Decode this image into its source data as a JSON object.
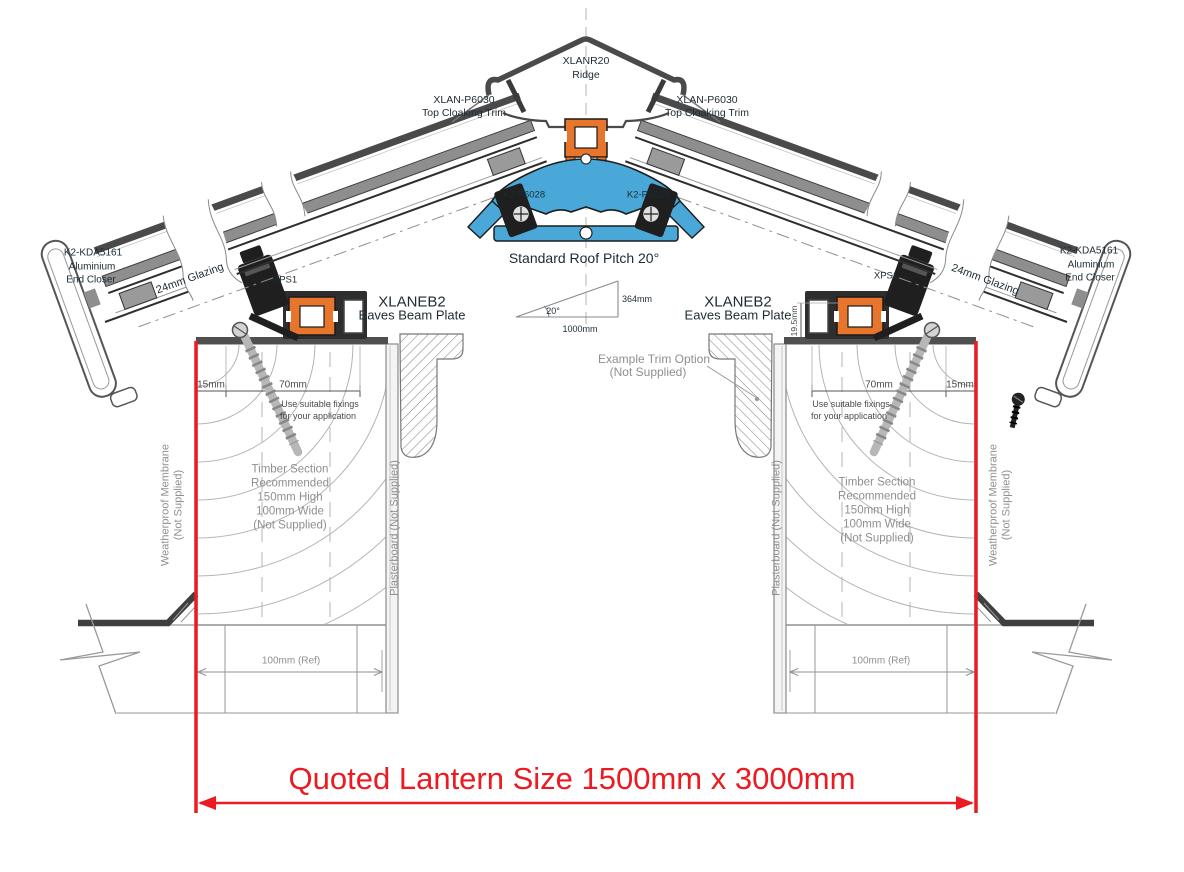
{
  "title": "Roof lantern eaves and ridge cross-section detail",
  "colors": {
    "accent_red": "#ec1a21",
    "aluminium_blue": "#49a8d8",
    "thermal_break_orange": "#e8752c"
  },
  "ridge": {
    "code": "XLANR20",
    "name": "Ridge"
  },
  "top_cloaking_trim": {
    "code": "XLAN-P6030",
    "name": "Top Cloaking Trim"
  },
  "ridge_fixing": {
    "code": "K2-P6028"
  },
  "pitch": {
    "caption": "Standard Roof Pitch 20°",
    "angle": "20°",
    "base": "1000mm",
    "rise": "364mm"
  },
  "end_closer": {
    "code": "K2-KDA5161",
    "material": "Aluminium",
    "name": "End Closer"
  },
  "glazing": {
    "label": "24mm Glazing"
  },
  "gasket": {
    "code": "XPS1"
  },
  "eaves_beam": {
    "code": "XLANEB2",
    "name": "Eaves Beam Plate"
  },
  "trim_option": {
    "line1": "Example  Trim Option",
    "line2": "(Not Supplied)"
  },
  "fixing_note": {
    "line1": "Use suitable fixings",
    "line2": "for your application"
  },
  "timber_note": {
    "lines": [
      "Timber Section",
      "Recommended",
      "150mm High",
      "100mm Wide",
      "(Not Supplied)"
    ]
  },
  "membrane": {
    "line1": "Weatherproof Membrane",
    "line2": "(Not Supplied)"
  },
  "plasterboard": {
    "label": "Plasterboard (Not Supplied)"
  },
  "dimensions": {
    "edge": "15mm",
    "fixing_zone": "70mm",
    "beam_height": "19.5mm",
    "kerb_ref": "100mm (Ref)"
  },
  "quoted_size": {
    "label": "Quoted Lantern Size 1500mm x 3000mm"
  }
}
